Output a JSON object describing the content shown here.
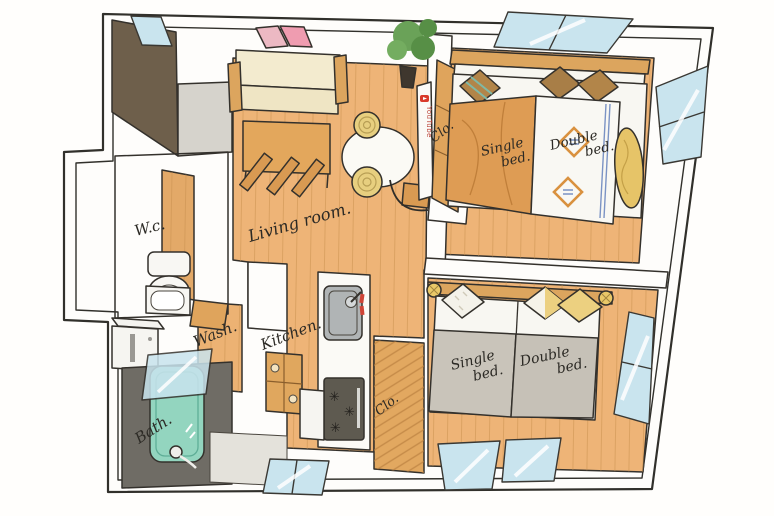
{
  "illustration": "hand-drawn apartment floor plan, isometric watercolor style",
  "labels": {
    "wc": "W.c.",
    "living": "Living room.",
    "wash": "Wash.",
    "kitchen": "Kitchen.",
    "bath": "Bath.",
    "closet_bedroom1": "Clo.",
    "closet_hall": "Clo.",
    "tv": "YouTube"
  },
  "bedroom1": {
    "single_l1": "Single",
    "single_l2": "bed.",
    "double_l1": "Double",
    "double_l2": "bed."
  },
  "bedroom2": {
    "single_l1": "Single",
    "single_l2": "bed.",
    "double_l1": "Double",
    "double_l2": "bed."
  },
  "colors": {
    "floor_wood": "#eeb477",
    "plank_line": "#c8904e",
    "wood_furniture": "#dca55e",
    "wall_white": "#fefdfb",
    "outline_ink": "#34312c",
    "window_glass": "#c9e4ee",
    "dark_brown_wall": "#6e5f4b",
    "gray_floor": "#d6d3cc",
    "bath_floor_gray": "#6f6c65",
    "bathtub_teal": "#93d5bf",
    "sofa_cream": "#f3ebcf",
    "duvet_gray": "#c9c4ba",
    "pillow_yellow": "#ecd080",
    "blanket_orange": "#de9c54",
    "blanket_yellow": "#e6c468",
    "art_pink": "#ef9cb0",
    "youtube_red": "#d93a2b",
    "stove_dark": "#5e5a50",
    "plant_green": "#6aa258",
    "accent_blue": "#7b93c4"
  }
}
